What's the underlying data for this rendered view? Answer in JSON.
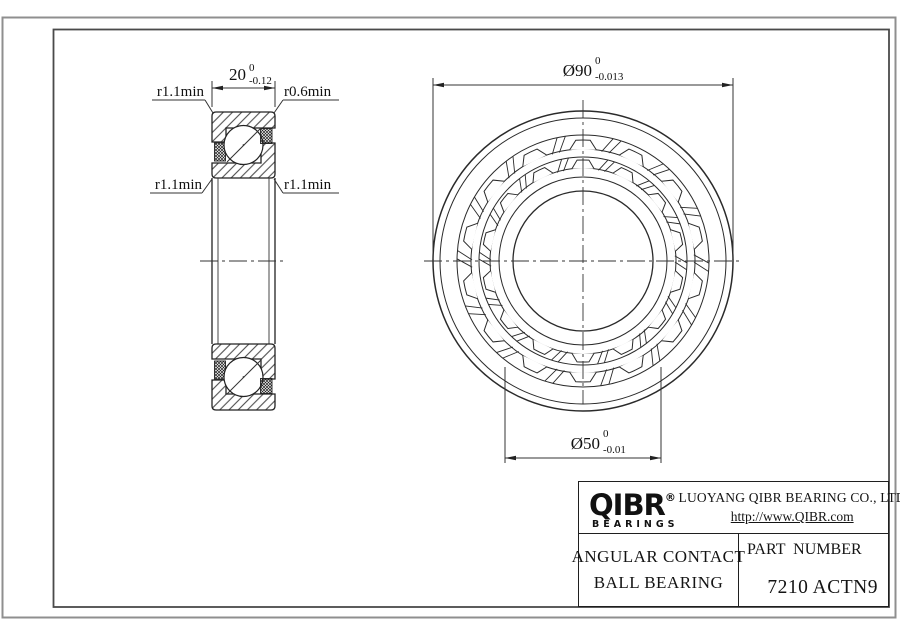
{
  "left_view": {
    "width_dim": {
      "value": "20",
      "tol_upper": "0",
      "tol_lower": "-0.12"
    },
    "fillet_top_left": "r1.1min",
    "fillet_top_right": "r0.6min",
    "fillet_bottom_left": "r1.1min",
    "fillet_bottom_right": "r1.1min"
  },
  "front_view": {
    "outer_dim": {
      "value": "Ø90",
      "tol_upper": "0",
      "tol_lower": "-0.013"
    },
    "bore_dim": {
      "value": "Ø50",
      "tol_upper": "0",
      "tol_lower": "-0.01"
    },
    "ball_pockets": 14
  },
  "title_block": {
    "logo_text": "QIBR",
    "logo_registered_mark": "®",
    "logo_subtext": "BEARINGS",
    "company_name": "LUOYANG QIBR BEARING CO., LTD",
    "website": "http://www.QIBR.com",
    "product_line1": "ANGULAR CONTACT",
    "product_line2": "BALL BEARING",
    "part_number_label": "PART  NUMBER",
    "part_number": "7210 ACTN9"
  },
  "colors": {
    "line": "#2a2a2a",
    "frame": "#4a4a4a",
    "outer_border": "#8f8f8f",
    "background": "#ffffff"
  }
}
